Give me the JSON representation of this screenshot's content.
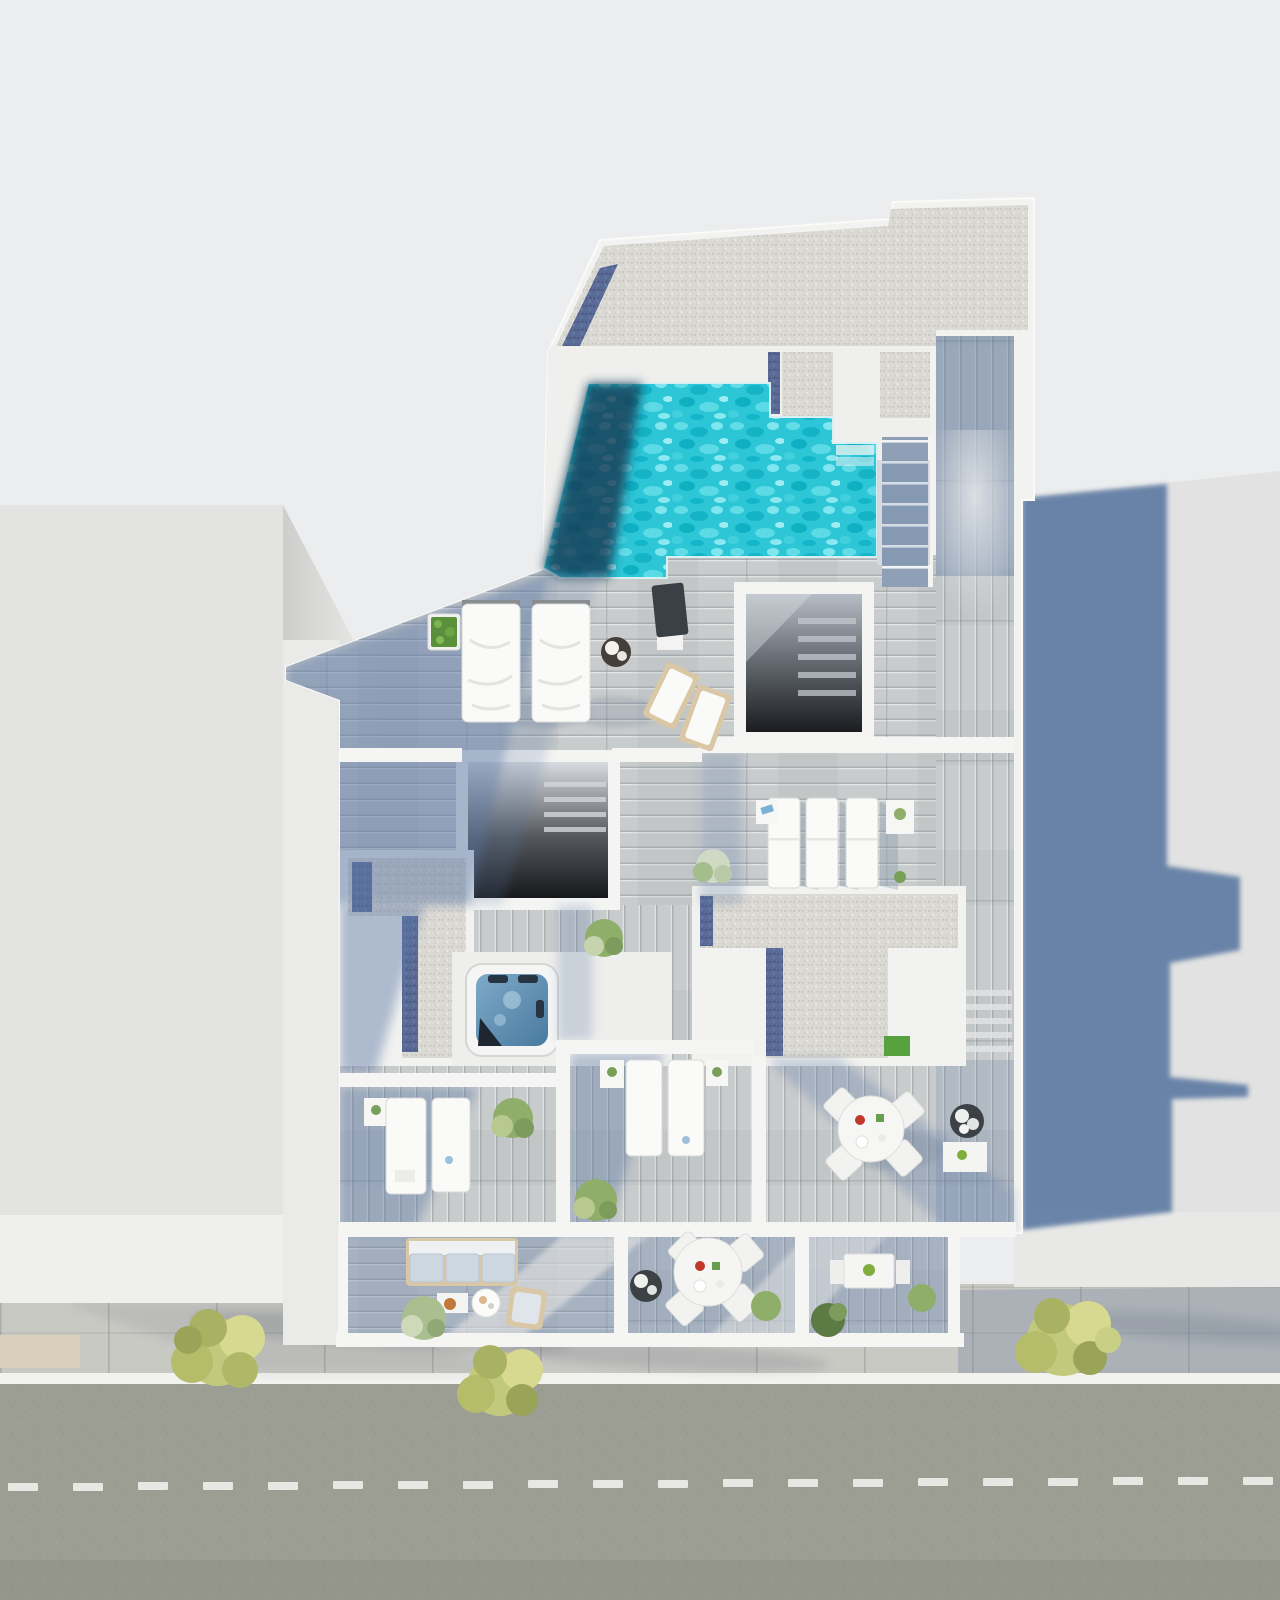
{
  "scene": {
    "description": "Top-down aerial 3D architectural rendering of a modern residential building rooftop with pool, terraces and street below",
    "view": "bird's-eye / plan view",
    "time_of_day": "sunny daylight, shadows cast to the lower-right",
    "street_markings": "dashed white center line and solid white curb line"
  },
  "legend": [
    "neighbor-building-left",
    "neighbor-building-right",
    "main-building-roof",
    "gravel-roof",
    "swimming-pool",
    "pool-steps",
    "roof-access-stairs",
    "stairwell-opening",
    "jacuzzi",
    "sun-lounger",
    "sun-bed",
    "deck-chair",
    "parasol",
    "dining-table-round",
    "dining-table-square",
    "sofa",
    "armchair",
    "coffee-table",
    "planter",
    "shrub",
    "street-tree",
    "sidewalk",
    "road"
  ],
  "counts": {
    "street_trees": 3,
    "twin_sun_beds": 2,
    "lounger_row_top": 3,
    "loungers_mid_left": 2,
    "loungers_mid_center": 2,
    "round_dining_tables": 2,
    "square_dining_tables": 1,
    "stairwell_openings": 2,
    "jacuzzis": 1,
    "pools": 1
  },
  "colors": {
    "background": "#ecedee",
    "neighbor_left": "#e3e4e2",
    "neighbor_right": "#e1e2e1",
    "facade_wedge": "#cdcdcb",
    "building_white": "#f2f2f0",
    "wall_white": "#f5f5f3",
    "wood_deck": "#c9cccd",
    "deck_shadow": "#5b78a6",
    "cast_shadow": "#54739f",
    "gravel": "#dbd9d3",
    "gravel_blue": "#5a6b97",
    "pool_water": "#2cc6d7",
    "pool_deep": "#153450",
    "pool_step": "#d8eef0",
    "jacuzzi_top": "#7fabc9",
    "jacuzzi_bottom": "#49799f",
    "stair_dark": "#1a1c20",
    "road": "#9c9e93",
    "sidewalk": "#c9c9c4",
    "curb_line": "#f2f2ef",
    "lane_dash": "#f0f0ec",
    "tan_paving": "#d8cfba",
    "tree_street": "#c3c97c",
    "tree_street_dark": "#a9b262",
    "tree_green": "#8fae6a",
    "tree_green_dark": "#5c7a44",
    "furniture_white": "#fafaf9",
    "cushion_blue": "#cdd7e0",
    "frame_tan": "#d9c7a6",
    "accent_orange": "#c07a3a",
    "accent_red": "#c0392b",
    "accent_green": "#7fae3f",
    "planter_dark": "#3c4146"
  }
}
